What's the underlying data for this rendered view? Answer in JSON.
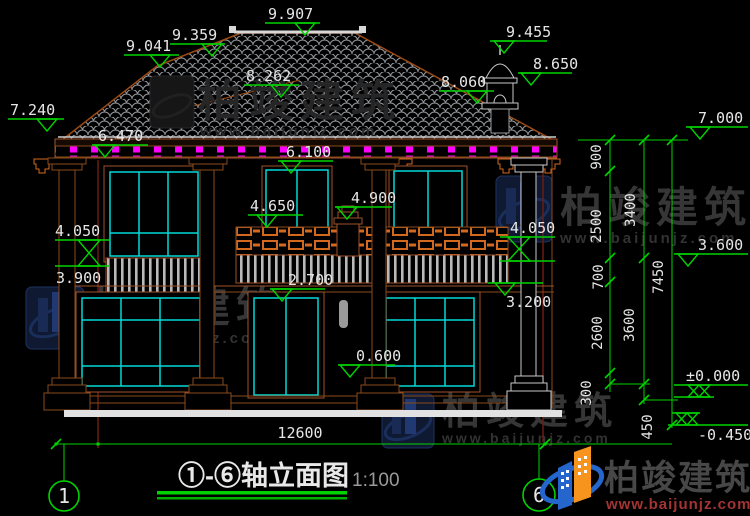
{
  "title": {
    "name": "①-⑥轴立面图",
    "scale": "1:100"
  },
  "axes": {
    "left": "1",
    "right": "6"
  },
  "elevations": {
    "v9907": "9.907",
    "v9455": "9.455",
    "v9359": "9.359",
    "v9041": "9.041",
    "v8650": "8.650",
    "v8262": "8.262",
    "v8060": "8.060",
    "v7240": "7.240",
    "v7000": "7.000",
    "v6470": "6.470",
    "v6100": "6.100",
    "v4900": "4.900",
    "v4650": "4.650",
    "v4050L": "4.050",
    "v4050R": "4.050",
    "v3900": "3.900",
    "v3600": "3.600",
    "v3200": "3.200",
    "v2700": "2.700",
    "v0600": "0.600",
    "v0000": "±0.000",
    "vm0450": "-0.450"
  },
  "dims": {
    "d900": "900",
    "d2500": "2500",
    "d3400": "3400",
    "d700": "700",
    "d2600": "2600",
    "d3600": "3600",
    "d7450": "7450",
    "d300": "300",
    "d450": "450",
    "total_width": "12600"
  },
  "watermark": {
    "brand": "柏竣建筑",
    "url": "www.baijunjz.com"
  },
  "brand_badge": {
    "name": "柏竣建筑",
    "url": "www.baijunjz.com"
  },
  "colors": {
    "dimension_green": "#00d400",
    "window_cyan": "#00d8d8",
    "trim_brown": "#a0522d",
    "rafter_magenta": "#ff00ff",
    "brand_blue": "#2566cc",
    "brand_orange": "#f7941d"
  }
}
